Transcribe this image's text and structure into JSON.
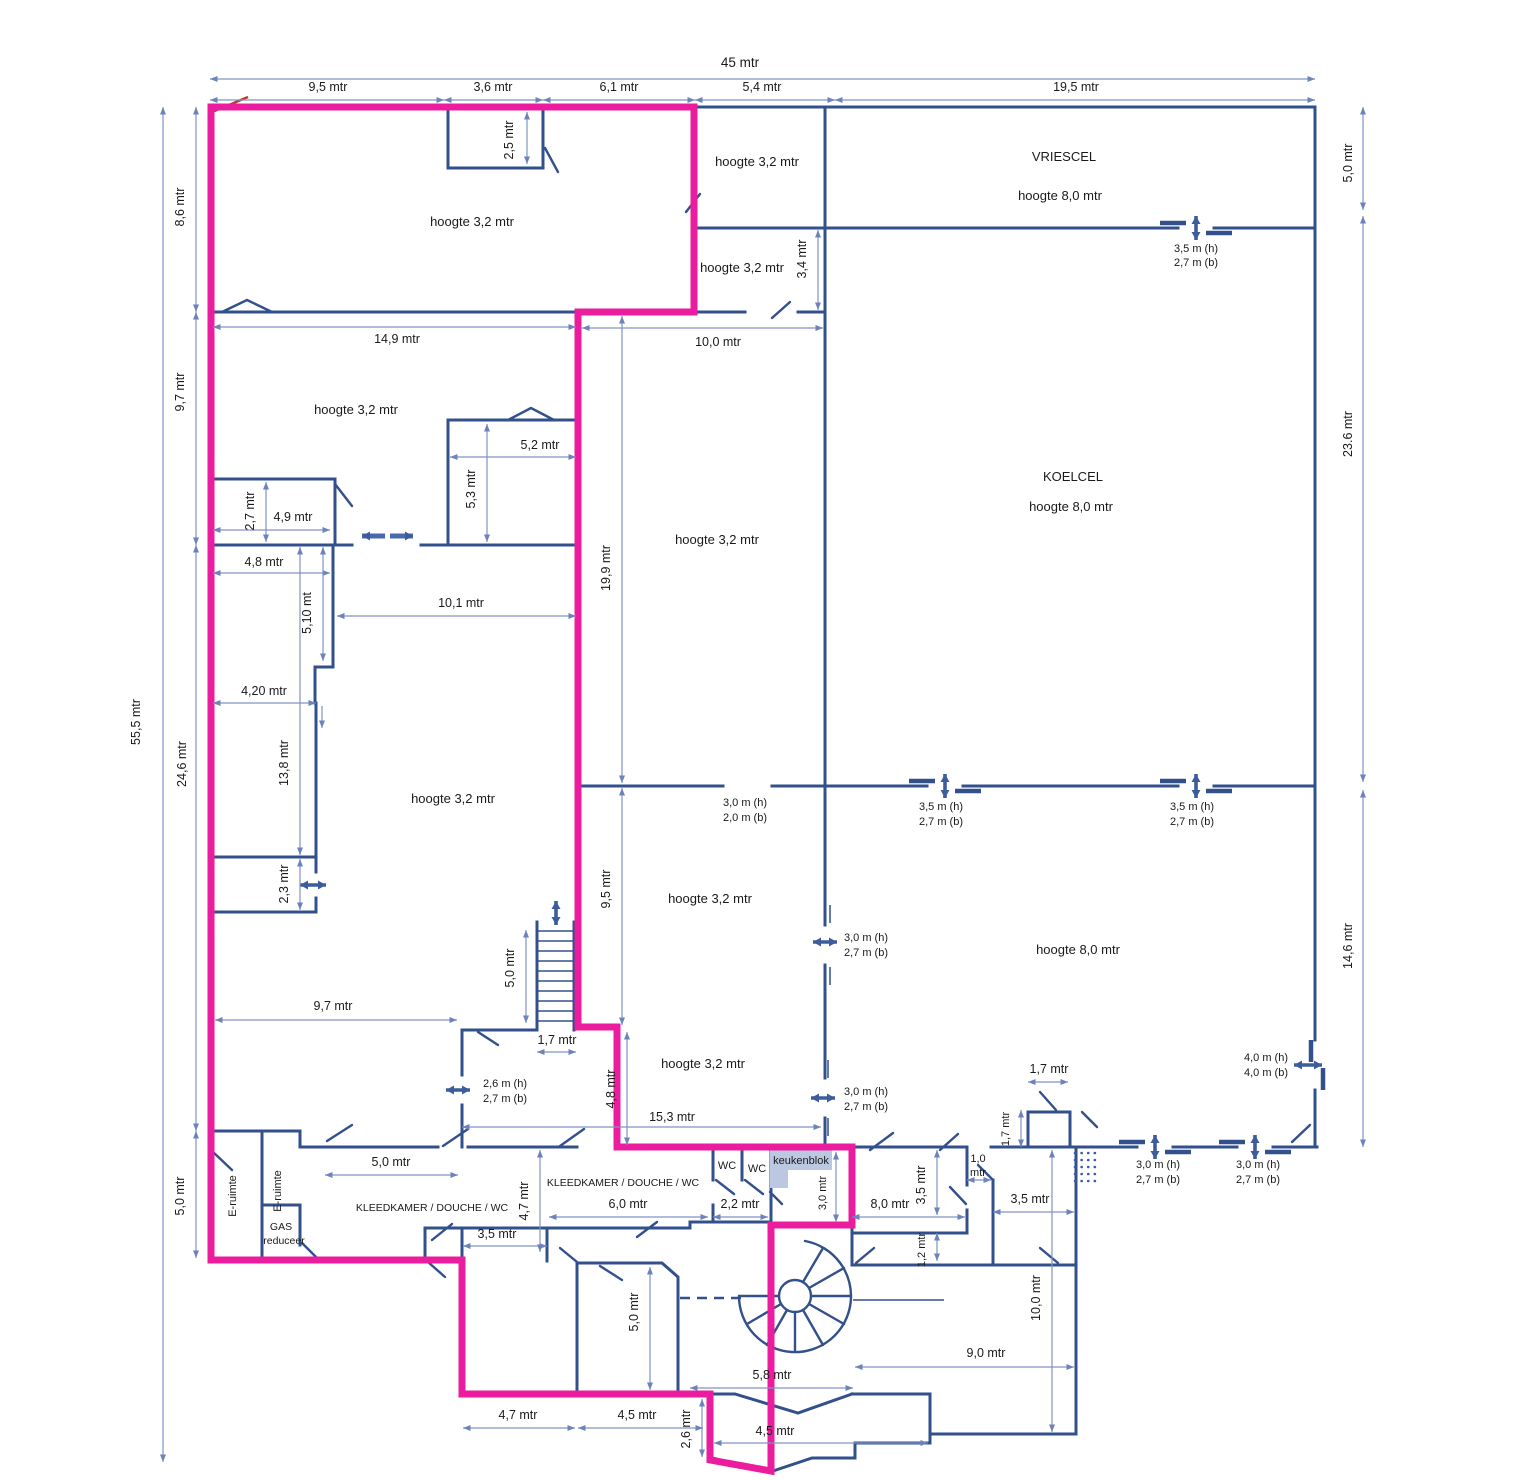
{
  "type": "floorplan",
  "units": "mtr",
  "colors": {
    "wall": "#32508c",
    "dimension_line": "#8093c5",
    "outline": "#eb1d9e",
    "text": "#1a1a1a",
    "keukenblok_fill": "#bcc7e1",
    "red_mark": "#c0392b"
  },
  "labels": {
    "v45": "45 mtr",
    "v95": "9,5 mtr",
    "v36": "3,6 mtr",
    "v61": "6,1 mtr",
    "v54": "5,4 mtr",
    "v195": "19,5 mtr",
    "v50": "5,0 mtr",
    "v236": "23.6 mtr",
    "v146": "14,6 mtr",
    "v555": "55,5 mtr",
    "v86": "8,6 mtr",
    "v97": "9,7 mtr",
    "v246": "24,6 mtr",
    "v25": "2,5 mtr",
    "v34": "3,4 mtr",
    "v149": "14,9 mtr",
    "v100": "10,0 mtr",
    "v52": "5,2 mtr",
    "v53": "5,3 mtr",
    "v199": "19,9 mtr",
    "v27": "2,7 mtr",
    "v49": "4,9 mtr",
    "v48": "4,8 mtr",
    "v510": "5,10 mt",
    "v101": "10,1 mtr",
    "v420": "4,20 mtr",
    "v138": "13,8 mtr",
    "v23": "2,3 mtr",
    "v153": "15,3 mtr",
    "v17": "1,7 mtr",
    "v35": "3,5 mtr",
    "v47": "4,7 mtr",
    "v60": "6,0 mtr",
    "v22": "2,2 mtr",
    "v30": "3,0 mtr",
    "v80": "8,0 mtr",
    "v10a": "1,0",
    "v10b": "mtr",
    "v12": "1,2 mtr",
    "v90": "9,0 mtr",
    "v58": "5,8 mtr",
    "v45b": "4,5 mtr",
    "v26": "2,6 mtr",
    "d35h": "3,5 m (h)",
    "d30h": "3,0 m (h)",
    "d26h": "2,6 m (h)",
    "d40h": "4,0 m (h)",
    "d27b": "2,7 m (b)",
    "d20b": "2,0 m (b)",
    "d40b": "4,0 m (b)",
    "hoogte32": "hoogte 3,2 mtr",
    "hoogte80": "hoogte 8,0 mtr",
    "vriescel": "VRIESCEL",
    "koelcel": "KOELCEL",
    "eruimte": "E-ruimte",
    "gas1": "GAS",
    "gas2": "reduceer",
    "kleedkamer": "KLEEDKAMER / DOUCHE / WC",
    "wc": "WC",
    "keukenblok": "keukenblok"
  }
}
